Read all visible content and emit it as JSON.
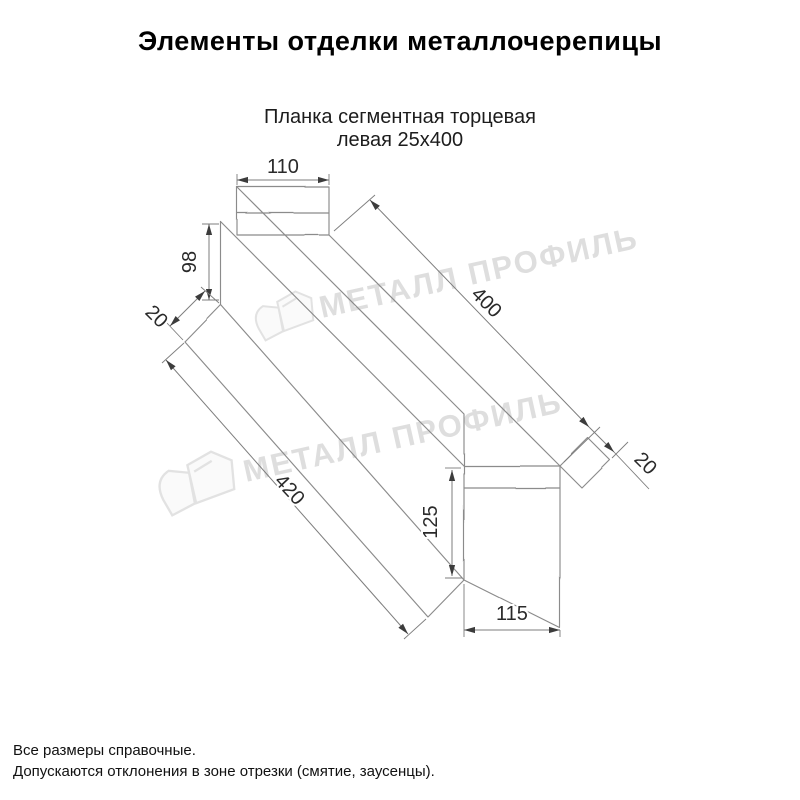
{
  "title": "Элементы отделки металлочерепицы",
  "subtitle": {
    "line1": "Планка сегментная торцевая",
    "line2": "левая 25х400"
  },
  "drawing": {
    "description": "oblique technical drawing of left segmental end strip",
    "line_color": "#8b8b8b",
    "dim_line_color": "#7d7d7d",
    "arrow_color": "#3c3c3c",
    "dims": {
      "top_flange_width": "110",
      "far_end_height": "98",
      "far_hem": "20",
      "top_edge_length": "400",
      "near_hem": "20",
      "bottom_edge_length": "420",
      "near_end_height": "125",
      "near_end_width": "115"
    }
  },
  "watermark": {
    "text": "МЕТАЛЛ ПРОФИЛЬ",
    "color": "#c4c4c4",
    "logo": "metall-profil-logo"
  },
  "footnotes": {
    "line1": "Все размеры справочные.",
    "line2": "Допускаются отклонения в зоне отрезки (смятие, заусенцы)."
  }
}
